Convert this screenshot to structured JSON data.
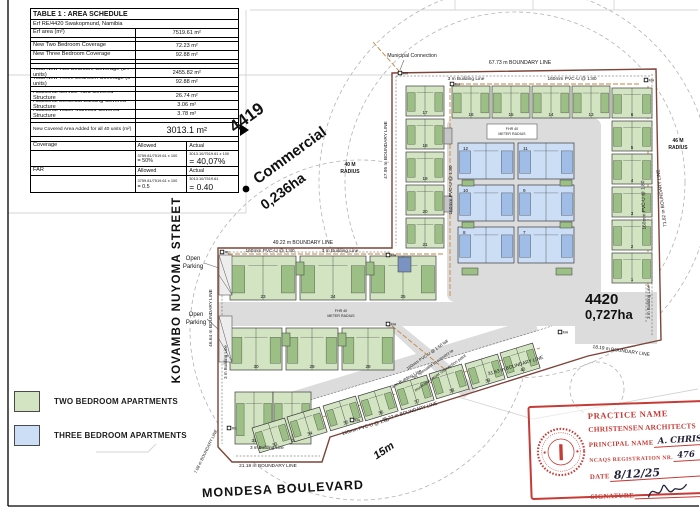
{
  "colors": {
    "two_bed": "#d3e4c2",
    "two_bed_dark": "#9cbf86",
    "three_bed": "#ccdef5",
    "three_bed_dark": "#9fbde6",
    "road": "#dcdcdc",
    "boundary": "#7d4438",
    "sewer": "#c8833c",
    "stamp_red": "#c63b36"
  },
  "table": {
    "title": "TABLE 1 : AREA SCHEDULE",
    "subtitle": "Erf RE/4420 Swakopmund, Namibia",
    "rows": [
      {
        "t": "d",
        "l": "Erf area (m²)",
        "v": "7519.61 m²",
        "h": 9
      },
      {
        "t": "b",
        "h": 4
      },
      {
        "t": "d",
        "l": "New Two Bedroom Coverage",
        "v": "72.23 m²",
        "h": 9
      },
      {
        "t": "d",
        "l": "New Three Bedroom Coverage",
        "v": "92.88 m²",
        "h": 9
      },
      {
        "t": "b",
        "h": 4
      },
      {
        "t": "b",
        "h": 5
      },
      {
        "t": "d",
        "l": "Total New Two Bedroom Coverage (34 units)",
        "v": "2455.82 m²",
        "h": 9
      },
      {
        "t": "d",
        "l": "Total New Three Bedroom Coverage (6 units)",
        "v": "92.88 m²",
        "h": 9
      },
      {
        "t": "b",
        "h": 5
      },
      {
        "t": "d",
        "l": "Additional Service Yard Covered Structure",
        "v": "26.74 m²",
        "h": 9
      },
      {
        "t": "d",
        "l": "Additional Electrical Building Covered Structure",
        "v": "3.06 m²",
        "h": 9
      },
      {
        "t": "d",
        "l": "Additional Water Manifold Covered Structure",
        "v": "3.78 m²",
        "h": 9
      },
      {
        "t": "b",
        "h": 4
      },
      {
        "t": "big",
        "l": "New Covered Area Added for all 40 units (m²)",
        "v": "3013.1 m²",
        "h": 14
      },
      {
        "t": "b",
        "h": 5
      }
    ],
    "coverage": {
      "label": "Coverage",
      "allowed_header": "Allowed",
      "actual_header": "Actual",
      "allowed_formula": "3759.81/7519.61 x 100",
      "allowed_result": "= 50%",
      "actual_formula": "3013.10/7519.61 x 100",
      "actual_result": "= 40,07%"
    },
    "far": {
      "label": "FAR",
      "allowed_header": "Allowed",
      "actual_header": "Actual",
      "allowed_formula": "3759.81/7519.61 x 100",
      "allowed_result": "= 0.5",
      "actual_formula": "3013.10/7519.61",
      "actual_result": "= 0.40"
    }
  },
  "labels": {
    "erf_adjacent": "4419",
    "commercial": "Commercial",
    "commercial_area": "0,236ha",
    "erf_main": "4420",
    "erf_main_area": "0,727ha",
    "street_west": "KOVAMBO NUYOMA STREET",
    "street_south": "MONDESA BOULEVARD",
    "road_width": "15m"
  },
  "legend": {
    "items": [
      {
        "label": "TWO BEDROOM APARTMENTS",
        "color": "#d3e4c2"
      },
      {
        "label": "THREE BEDROOM APARTMENTS",
        "color": "#ccdef5"
      }
    ]
  },
  "stamp": {
    "practice_label": "PRACTICE NAME",
    "practice_name": "CHRISTENSEN ARCHITECTS",
    "principal_label": "PRINCIPAL NAME",
    "principal_value": "A. CHRISTENSEN",
    "registration_label": "NCAQS REGISTRATION NR.",
    "registration_value": "476",
    "date_label": "DATE",
    "date_value": "8/12/25",
    "signature_label": "SIGNATURE"
  },
  "site": {
    "faint": [
      [
        250,
        10,
        698,
        10
      ],
      [
        455,
        0,
        455,
        10
      ],
      [
        533,
        0,
        533,
        10
      ],
      [
        614,
        0,
        614,
        10
      ],
      [
        8,
        75,
        392,
        75
      ],
      [
        246,
        10,
        246,
        213
      ],
      [
        8,
        213,
        246,
        213
      ],
      [
        428,
        388,
        533,
        419
      ],
      [
        533,
        419,
        698,
        389
      ],
      [
        96,
        452,
        148,
        452
      ],
      [
        148,
        452,
        156,
        444
      ]
    ],
    "circles": [
      [
        515,
        182,
        170
      ],
      [
        515,
        182,
        196
      ],
      [
        360,
        330,
        170
      ],
      [
        597,
        389,
        27
      ]
    ],
    "boundary": "392,73 656,69 661,340 588,356 474,392 330,437 322,462 232,462 218,447 218,248 392,248",
    "roads": [
      {
        "rect": [
          447,
          118,
          154,
          184,
          8
        ]
      },
      {
        "rect": [
          218,
          302,
          384,
          24,
          0
        ]
      },
      {
        "rect": [
          575,
          292,
          82,
          52,
          0
        ]
      },
      {
        "poly": "386,326 402,326 478,388 464,398"
      },
      {
        "poly": "242,421 538,331 534,318 238,408"
      }
    ],
    "blines": [
      [
        396,
        76,
        650,
        76
      ],
      [
        396,
        76,
        396,
        246
      ],
      [
        652,
        74,
        652,
        336
      ],
      [
        222,
        252,
        390,
        252
      ],
      [
        222,
        252,
        222,
        444
      ],
      [
        236,
        456,
        320,
        456
      ],
      [
        646,
        284,
        646,
        322
      ],
      [
        238,
        422,
        552,
        326
      ]
    ],
    "sewer": [
      [
        452,
        84,
        640,
        84
      ],
      [
        450,
        88,
        450,
        298
      ],
      [
        648,
        86,
        648,
        288
      ],
      [
        228,
        254,
        444,
        254
      ],
      [
        250,
        440,
        540,
        348
      ],
      [
        392,
        326,
        470,
        390
      ],
      [
        373,
        42,
        399,
        71
      ]
    ],
    "leaders": [
      [
        204,
        263,
        219,
        268
      ],
      [
        207,
        319,
        219,
        330
      ],
      [
        404,
        60,
        400,
        70
      ]
    ],
    "green_blocks": [
      {
        "x": 452,
        "y": 86,
        "w": 38,
        "h": 32,
        "n": "16"
      },
      {
        "x": 492,
        "y": 86,
        "w": 38,
        "h": 32,
        "n": "15"
      },
      {
        "x": 532,
        "y": 86,
        "w": 38,
        "h": 32,
        "n": "14"
      },
      {
        "x": 572,
        "y": 86,
        "w": 38,
        "h": 32,
        "n": "13"
      },
      {
        "x": 406,
        "y": 86,
        "w": 38,
        "h": 30,
        "n": "17"
      },
      {
        "x": 406,
        "y": 119,
        "w": 38,
        "h": 30,
        "n": "18"
      },
      {
        "x": 406,
        "y": 152,
        "w": 38,
        "h": 30,
        "n": "19"
      },
      {
        "x": 406,
        "y": 185,
        "w": 38,
        "h": 30,
        "n": "20"
      },
      {
        "x": 406,
        "y": 218,
        "w": 38,
        "h": 30,
        "n": "21"
      },
      {
        "x": 612,
        "y": 88,
        "w": 40,
        "h": 30,
        "n": "6"
      },
      {
        "x": 612,
        "y": 121,
        "w": 40,
        "h": 30,
        "n": "5"
      },
      {
        "x": 612,
        "y": 154,
        "w": 40,
        "h": 30,
        "n": "4"
      },
      {
        "x": 612,
        "y": 187,
        "w": 40,
        "h": 30,
        "n": "3"
      },
      {
        "x": 612,
        "y": 220,
        "w": 40,
        "h": 30,
        "n": "2"
      },
      {
        "x": 612,
        "y": 253,
        "w": 40,
        "h": 30,
        "n": "1"
      },
      {
        "x": 230,
        "y": 256,
        "w": 66,
        "h": 44,
        "n": "23"
      },
      {
        "x": 300,
        "y": 256,
        "w": 66,
        "h": 44,
        "n": "24"
      },
      {
        "x": 370,
        "y": 256,
        "w": 66,
        "h": 44,
        "n": "25"
      },
      {
        "x": 230,
        "y": 328,
        "w": 52,
        "h": 42,
        "n": "30"
      },
      {
        "x": 286,
        "y": 328,
        "w": 52,
        "h": 42,
        "n": "29"
      },
      {
        "x": 342,
        "y": 328,
        "w": 52,
        "h": 42,
        "n": "28"
      },
      {
        "x": 235,
        "y": 392,
        "w": 38,
        "h": 52,
        "n": "31"
      },
      {
        "x": 273,
        "y": 392,
        "w": 38,
        "h": 52,
        "n": "32"
      },
      {
        "x": 252,
        "y": 428,
        "w": 34,
        "h": 26,
        "n": "33",
        "r": -17
      },
      {
        "x": 287,
        "y": 417,
        "w": 34,
        "h": 26,
        "n": "34",
        "r": -17
      },
      {
        "x": 323,
        "y": 406,
        "w": 34,
        "h": 26,
        "n": "35",
        "r": -17
      },
      {
        "x": 358,
        "y": 396,
        "w": 34,
        "h": 26,
        "n": "36",
        "r": -17
      },
      {
        "x": 394,
        "y": 385,
        "w": 34,
        "h": 26,
        "n": "37",
        "r": -17
      },
      {
        "x": 429,
        "y": 374,
        "w": 34,
        "h": 26,
        "n": "38",
        "r": -17
      },
      {
        "x": 465,
        "y": 364,
        "w": 34,
        "h": 26,
        "n": "39",
        "r": -17
      },
      {
        "x": 500,
        "y": 353,
        "w": 34,
        "h": 26,
        "n": "40",
        "r": -17
      }
    ],
    "blue_blocks": [
      {
        "x": 458,
        "y": 143,
        "w": 56,
        "h": 36,
        "n": "12",
        "tn": 1
      },
      {
        "x": 518,
        "y": 143,
        "w": 56,
        "h": 36,
        "n": "11",
        "tn": 1
      },
      {
        "x": 458,
        "y": 185,
        "w": 56,
        "h": 36,
        "n": "10",
        "tn": 1
      },
      {
        "x": 518,
        "y": 185,
        "w": 56,
        "h": 36,
        "n": "9",
        "tn": 1
      },
      {
        "x": 458,
        "y": 227,
        "w": 56,
        "h": 36,
        "n": "8",
        "tn": 1
      },
      {
        "x": 518,
        "y": 227,
        "w": 56,
        "h": 36,
        "n": "7",
        "tn": 1
      }
    ],
    "structures": [
      [
        444,
        128,
        8,
        16,
        "#c6c6c6"
      ],
      [
        444,
        196,
        8,
        16,
        "#c6c6c6"
      ],
      [
        296,
        262,
        8,
        13,
        "#9cbf86"
      ],
      [
        366,
        262,
        8,
        13,
        "#9cbf86"
      ],
      [
        282,
        333,
        8,
        13,
        "#9cbf86"
      ],
      [
        338,
        333,
        8,
        13,
        "#9cbf86"
      ],
      [
        398,
        257,
        13,
        15,
        "#7b93c0"
      ],
      [
        487,
        124,
        50,
        15,
        "#ffffff"
      ],
      [
        462,
        268,
        16,
        7,
        "#9cbf86"
      ],
      [
        556,
        268,
        16,
        7,
        "#9cbf86"
      ],
      [
        462,
        180,
        12,
        6,
        "#9cbf86"
      ],
      [
        560,
        180,
        12,
        6,
        "#9cbf86"
      ],
      [
        462,
        222,
        12,
        6,
        "#9cbf86"
      ],
      [
        560,
        222,
        12,
        6,
        "#9cbf86"
      ]
    ],
    "parking": [
      [
        219,
        255,
        13,
        40
      ],
      [
        219,
        316,
        13,
        46
      ]
    ],
    "manholes": [
      [
        400,
        73,
        "MH"
      ],
      [
        646,
        80,
        "MH"
      ],
      [
        452,
        84,
        "MH"
      ],
      [
        388,
        255,
        "MH"
      ],
      [
        388,
        324,
        "MH"
      ],
      [
        560,
        332,
        "MH"
      ],
      [
        352,
        420,
        "MH"
      ],
      [
        222,
        252,
        "RE"
      ],
      [
        229,
        428,
        "RE"
      ]
    ],
    "labels": [
      {
        "t": "Municipal Connection",
        "x": 412,
        "y": 57,
        "s": 5.2
      },
      {
        "t": "67.73 m BOUNDARY LINE",
        "x": 520,
        "y": 64,
        "s": 5.2
      },
      {
        "t": "3 m Building Line",
        "x": 466,
        "y": 80,
        "s": 4.8
      },
      {
        "t": "160mm PVC-U @ 1:80",
        "x": 572,
        "y": 80,
        "s": 4.8
      },
      {
        "t": "47.95 m BOUNDARY LINE",
        "x": 387,
        "y": 150,
        "s": 4.8,
        "r": -90
      },
      {
        "t": "160mm PVC-U @ 1:80",
        "x": 452,
        "y": 190,
        "s": 4.8,
        "r": -90
      },
      {
        "t": "160mm PVC-U @ 1:80",
        "x": 645,
        "y": 205,
        "s": 4.8,
        "r": -92
      },
      {
        "t": "71.62 m BOUNDARY LINE",
        "x": 663,
        "y": 198,
        "s": 4.8,
        "r": -97
      },
      {
        "t": "46 M",
        "x": 678,
        "y": 142,
        "s": 5,
        "b": 1
      },
      {
        "t": "RADIUS",
        "x": 678,
        "y": 149,
        "s": 5,
        "b": 1
      },
      {
        "t": "40 M",
        "x": 350,
        "y": 166,
        "s": 5,
        "b": 1
      },
      {
        "t": "RADIUS",
        "x": 350,
        "y": 173,
        "s": 5,
        "b": 1
      },
      {
        "t": "FHR 40",
        "x": 512,
        "y": 130,
        "s": 3.6
      },
      {
        "t": "METER RADIUS",
        "x": 512,
        "y": 135,
        "s": 3.6
      },
      {
        "t": "FHR 40",
        "x": 341,
        "y": 312,
        "s": 3.6
      },
      {
        "t": "METER RADIUS",
        "x": 341,
        "y": 317,
        "s": 3.6
      },
      {
        "t": "49.22 m BOUNDARY LINE",
        "x": 303,
        "y": 244,
        "s": 5
      },
      {
        "t": "160mm PVC-U @ 1:80",
        "x": 270,
        "y": 252,
        "s": 4.8
      },
      {
        "t": "3 m Building Line",
        "x": 340,
        "y": 252,
        "s": 4.8
      },
      {
        "t": "46.64 m BOUNDARY LINE",
        "x": 212,
        "y": 318,
        "s": 4.8,
        "r": -90
      },
      {
        "t": "3 m Building Line",
        "x": 227,
        "y": 362,
        "s": 4.4,
        "r": -90
      },
      {
        "t": "Open",
        "x": 193,
        "y": 260,
        "s": 6
      },
      {
        "t": "Parking",
        "x": 193,
        "y": 268,
        "s": 6
      },
      {
        "t": "Open",
        "x": 196,
        "y": 316,
        "s": 6
      },
      {
        "t": "Parking",
        "x": 196,
        "y": 324,
        "s": 6
      },
      {
        "t": "18.19 m BOUNDARY LINE",
        "x": 621,
        "y": 352,
        "s": 4.8,
        "r": 8
      },
      {
        "t": "31.63 m BOUNDARY LINE",
        "x": 516,
        "y": 367,
        "s": 4.8,
        "r": -17
      },
      {
        "t": "45.22 m BOUNDARY LINE",
        "x": 410,
        "y": 413,
        "s": 4.8,
        "r": -17
      },
      {
        "t": "160mm PVC-U @ 1:80",
        "x": 366,
        "y": 428,
        "s": 4.8,
        "r": -17
      },
      {
        "t": "3 m Building Line",
        "x": 407,
        "y": 380,
        "s": 4.4,
        "r": -30
      },
      {
        "t": "160mm PVC-U @ 1:50 fall",
        "x": 428,
        "y": 356,
        "s": 4.2,
        "r": -35
      },
      {
        "t": "by specialist to connect to",
        "x": 434,
        "y": 365,
        "s": 4.2,
        "r": -35
      },
      {
        "t": "municipal sewer connection point",
        "x": 441,
        "y": 374,
        "s": 4.2,
        "r": -35
      },
      {
        "t": "3 m Building Line",
        "x": 650,
        "y": 302,
        "s": 4.4,
        "r": -90
      },
      {
        "t": "3 m Building Line",
        "x": 267,
        "y": 449,
        "s": 4.4
      },
      {
        "t": "21.18 m BOUNDARY LINE",
        "x": 268,
        "y": 467,
        "s": 4.8
      },
      {
        "t": "7.08 m BOUNDARY LINE",
        "x": 207,
        "y": 452,
        "s": 4.2,
        "r": -64
      }
    ],
    "marks": {
      "tri": "240,124 240,136 249,130",
      "dot": [
        246,
        189,
        3.4
      ]
    },
    "frame": [
      [
        8,
        0,
        8,
        506
      ],
      [
        8,
        506,
        699,
        506
      ]
    ]
  }
}
